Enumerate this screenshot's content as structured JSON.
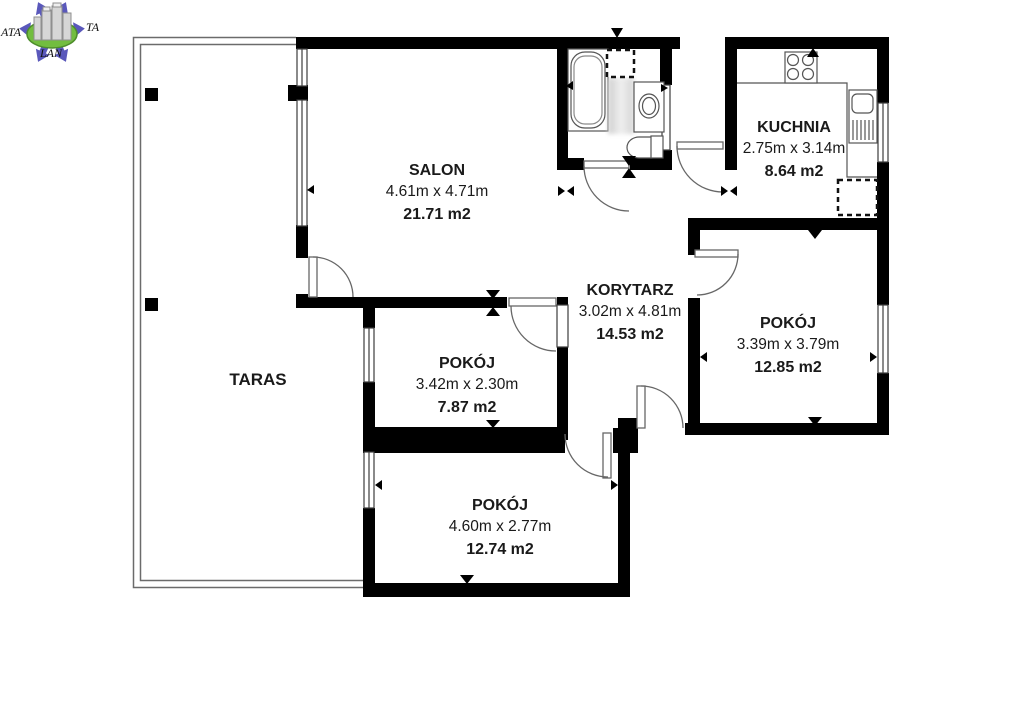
{
  "logo": {
    "text_left": "ATA",
    "text_right": "TA",
    "text_bottom": "LAN",
    "arrow_color": "#5a58bb",
    "ellipse_color": "#72bd3f",
    "building_color": "#d6d6d6"
  },
  "rooms": [
    {
      "id": "salon",
      "name": "SALON",
      "dimensions": "4.61m x 4.71m",
      "area": "21.71 m2"
    },
    {
      "id": "kuchnia",
      "name": "KUCHNIA",
      "dimensions": "2.75m x 3.14m",
      "area": "8.64 m2"
    },
    {
      "id": "korytarz",
      "name": "KORYTARZ",
      "dimensions": "3.02m x 4.81m",
      "area": "14.53 m2"
    },
    {
      "id": "pokoj_right",
      "name": "POKÓJ",
      "dimensions": "3.39m x 3.79m",
      "area": "12.85 m2"
    },
    {
      "id": "pokoj_middle",
      "name": "POKÓJ",
      "dimensions": "3.42m x 2.30m",
      "area": "7.87 m2"
    },
    {
      "id": "pokoj_bottom",
      "name": "POKÓJ",
      "dimensions": "4.60m x 2.77m",
      "area": "12.74 m2"
    },
    {
      "id": "taras",
      "name": "TARAS",
      "dimensions": "",
      "area": ""
    }
  ],
  "colors": {
    "wall": "#000000",
    "thin_line": "#555555",
    "background": "#ffffff",
    "text": "#1a1a1a"
  }
}
